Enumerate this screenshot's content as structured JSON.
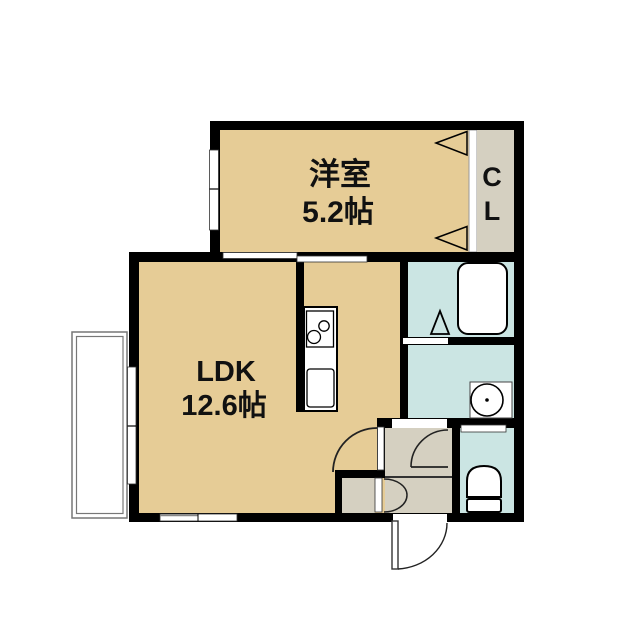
{
  "floorplan": {
    "title": "1LDK apartment floor plan",
    "rooms": {
      "western_room": {
        "name": "洋室",
        "size": "5.2帖"
      },
      "ldk": {
        "name": "LDK",
        "size": "12.6帖"
      },
      "closet": {
        "letter_top": "C",
        "letter_bottom": "L"
      }
    },
    "fixtures": [
      "bathtub",
      "bath-folding-door",
      "wash-basin",
      "toilet",
      "kitchen-counter",
      "kitchen-stove",
      "kitchen-sink",
      "closet-folding-door",
      "storage-bifold-door",
      "entrance-door",
      "interior-door",
      "sliding-window",
      "balcony"
    ],
    "colors": {
      "room_floor": "#e6cc96",
      "wet_area": "#cbe5e3",
      "service_area": "#d5d0c1",
      "wall": "#000000",
      "background": "#ffffff"
    }
  }
}
